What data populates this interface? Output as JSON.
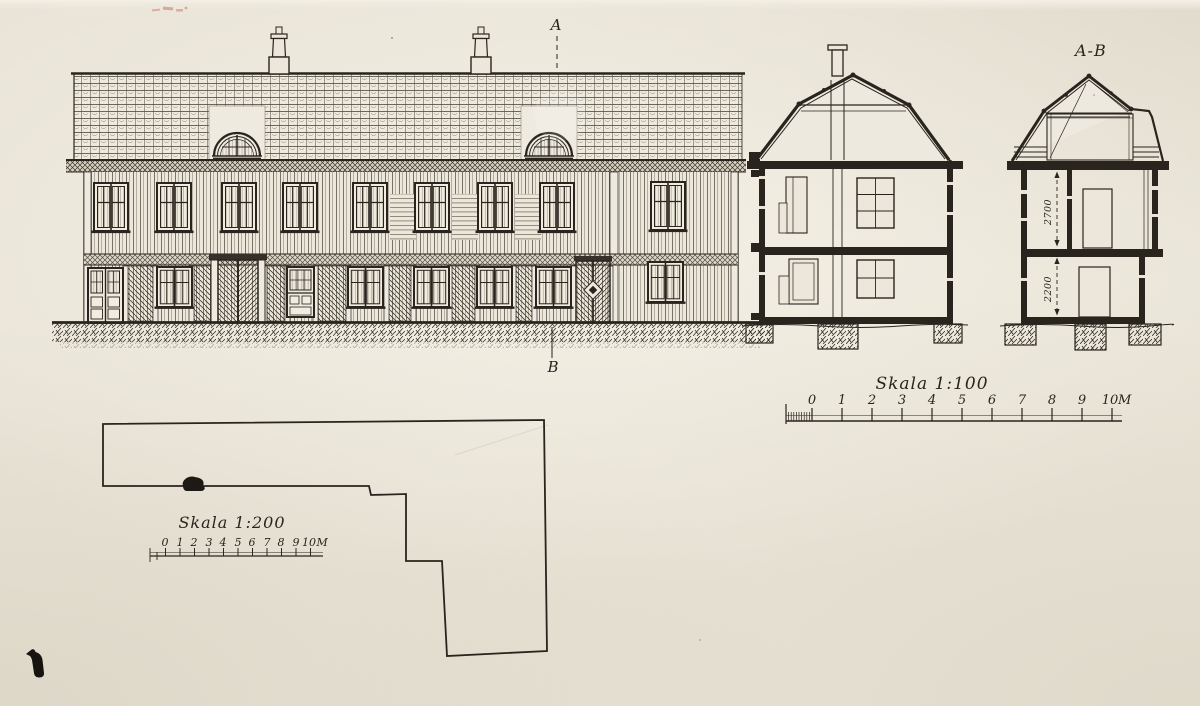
{
  "colors": {
    "paper": "#e9e4d7",
    "ink": "#29251e"
  },
  "labels": {
    "section_top": "A",
    "section_bottom": "B",
    "section_view": "A-B"
  },
  "scale_100": {
    "label": "Skala 1:100",
    "ticks": [
      "0",
      "1",
      "2",
      "3",
      "4",
      "5",
      "6",
      "7",
      "8",
      "9",
      "10"
    ],
    "unit": "M"
  },
  "scale_200": {
    "label": "Skala 1:200",
    "ticks": [
      "0",
      "1",
      "2",
      "3",
      "4",
      "5",
      "6",
      "7",
      "8",
      "9",
      "10"
    ],
    "unit": "M"
  },
  "dimensions": {
    "upper_storey": "2700",
    "lower_storey": "2200"
  }
}
